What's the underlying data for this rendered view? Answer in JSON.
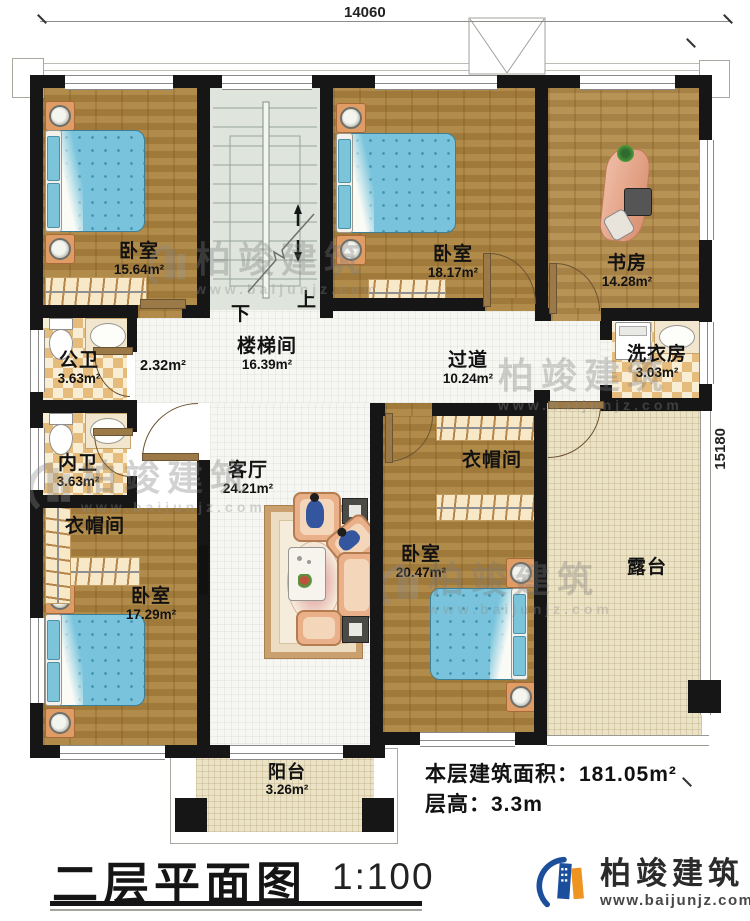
{
  "dimensions": {
    "top": "14060",
    "right": "15180"
  },
  "stairs": {
    "up": "上",
    "down": "下"
  },
  "rooms": [
    {
      "id": "bedroom-top-left",
      "name": "卧室",
      "area": "15.64m²"
    },
    {
      "id": "bedroom-top-middle",
      "name": "卧室",
      "area": "18.17m²"
    },
    {
      "id": "study",
      "name": "书房",
      "area": "14.28m²"
    },
    {
      "id": "stairwell",
      "name": "楼梯间",
      "area": "16.39m²"
    },
    {
      "id": "vestibule",
      "name": "",
      "area": "2.32m²"
    },
    {
      "id": "public-bathroom",
      "name": "公卫",
      "area": "3.63m²"
    },
    {
      "id": "private-bathroom",
      "name": "内卫",
      "area": "3.63m²"
    },
    {
      "id": "corridor",
      "name": "过道",
      "area": "10.24m²"
    },
    {
      "id": "laundry",
      "name": "洗衣房",
      "area": "3.03m²"
    },
    {
      "id": "living-room",
      "name": "客厅",
      "area": "24.21m²"
    },
    {
      "id": "cloakroom-left",
      "name": "衣帽间",
      "area": ""
    },
    {
      "id": "cloakroom-right",
      "name": "衣帽间",
      "area": ""
    },
    {
      "id": "bedroom-bottom-left",
      "name": "卧室",
      "area": "17.29m²"
    },
    {
      "id": "bedroom-bottom-right",
      "name": "卧室",
      "area": "20.47m²"
    },
    {
      "id": "terrace",
      "name": "露台",
      "area": ""
    },
    {
      "id": "balcony",
      "name": "阳台",
      "area": "3.26m²"
    }
  ],
  "stats": {
    "area_label": "本层建筑面积：",
    "area_value": "181.05m²",
    "height_label": "层高：",
    "height_value": "3.3m"
  },
  "title": {
    "text": "二层平面图",
    "scale": "1:100"
  },
  "brand": {
    "name": "柏竣建筑",
    "url": "www.baijunjz.com"
  },
  "watermark": {
    "name": "柏竣建筑",
    "url": "www.baijunjz.com"
  },
  "colors": {
    "wall": "#161616",
    "wood": "#a8813f",
    "bed": "#79c4dc",
    "tile": "#e6bc7c",
    "terrace": "#ece3c6",
    "brand_blue": "#1b4f9c",
    "brand_orange": "#ef9420"
  }
}
